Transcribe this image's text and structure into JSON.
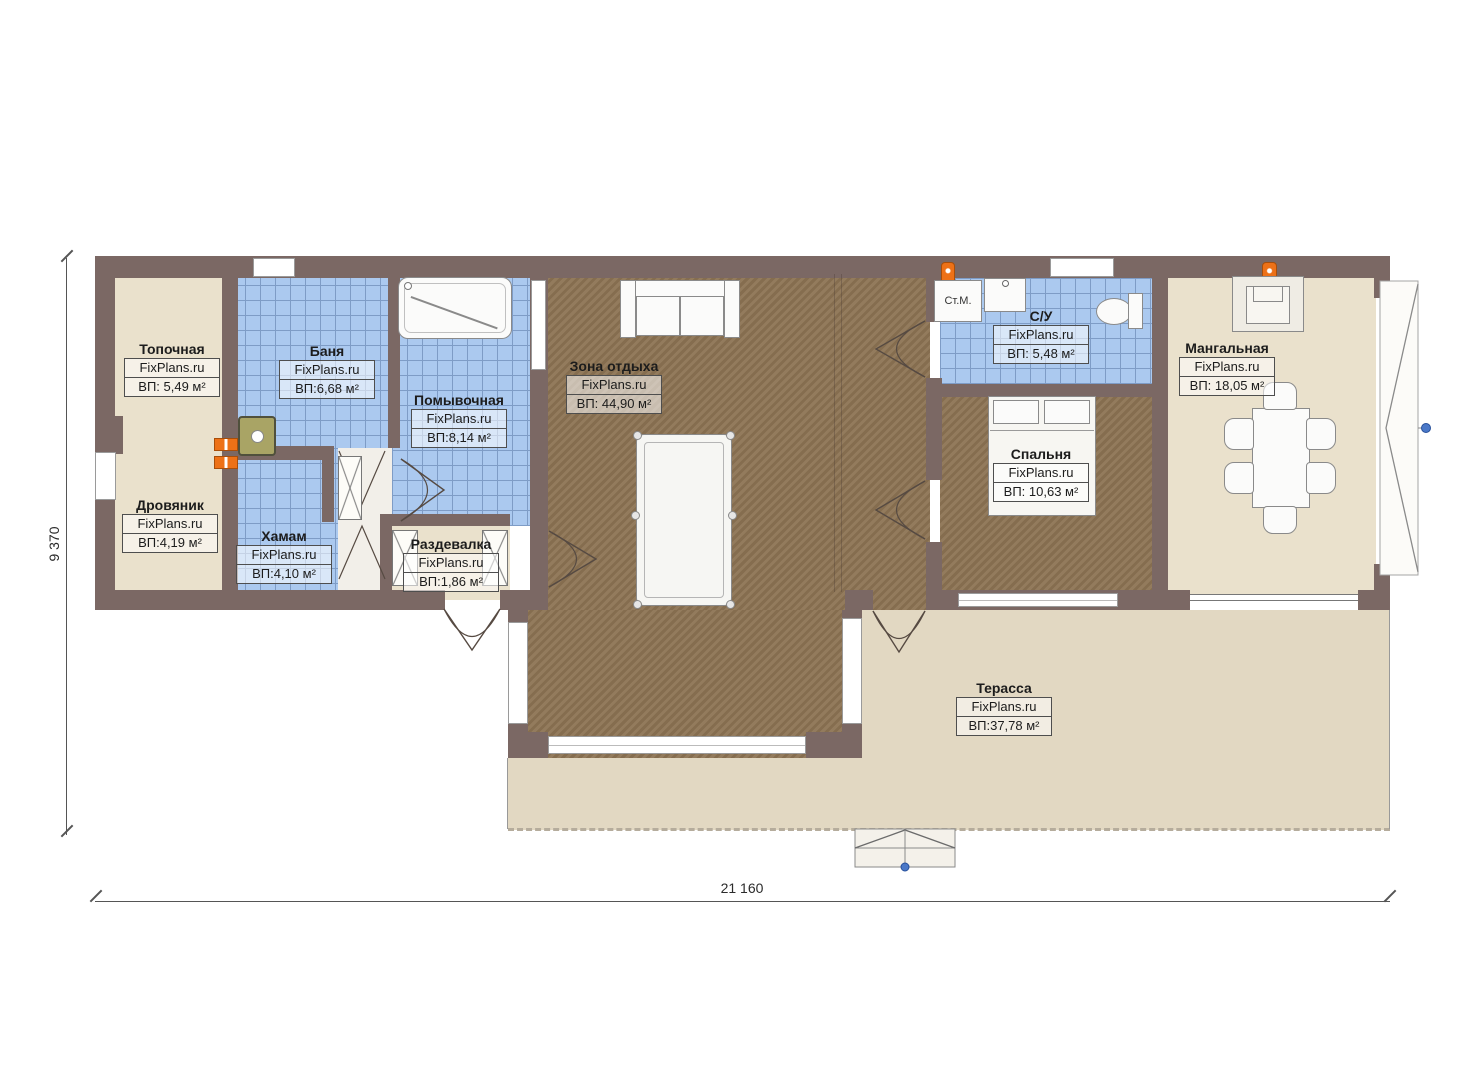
{
  "plan": {
    "watermark": "FixPlans.ru",
    "rooms": {
      "topochnaya": {
        "name": "Топочная",
        "area": "ВП: 5,49 м²"
      },
      "drovyanik": {
        "name": "Дровяник",
        "area": "ВП:4,19 м²"
      },
      "banya": {
        "name": "Баня",
        "area": "ВП:6,68 м²"
      },
      "khamam": {
        "name": "Хамам",
        "area": "ВП:4,10 м²"
      },
      "pomyvochnaya": {
        "name": "Помывочная",
        "area": "ВП:8,14 м²"
      },
      "razdevalka": {
        "name": "Раздевалка",
        "area": "ВП:1,86 м²"
      },
      "zona_otdykha": {
        "name": "Зона отдыха",
        "area": "ВП: 44,90 м²"
      },
      "su": {
        "name": "С/У",
        "area": "ВП: 5,48 м²"
      },
      "spalnya": {
        "name": "Спальня",
        "area": "ВП: 10,63 м²"
      },
      "mangalnaya": {
        "name": "Мангальная",
        "area": "ВП: 18,05 м²"
      },
      "terrassa": {
        "name": "Терасса",
        "area": "ВП:37,78 м²"
      }
    },
    "fixtures": {
      "washing_machine": "Ст.М."
    },
    "dimensions": {
      "width_mm": "21 160",
      "height_mm": "9 370"
    },
    "colors": {
      "wall": "#7b6864",
      "tile": "#abc9ef",
      "tile_grid": "#7e9cc6",
      "wood": "#8d7454",
      "beige": "#eae1cc",
      "terrace": "#e2d8c2",
      "orange": "#ed7117",
      "handle_blue": "#4a78c8"
    }
  }
}
